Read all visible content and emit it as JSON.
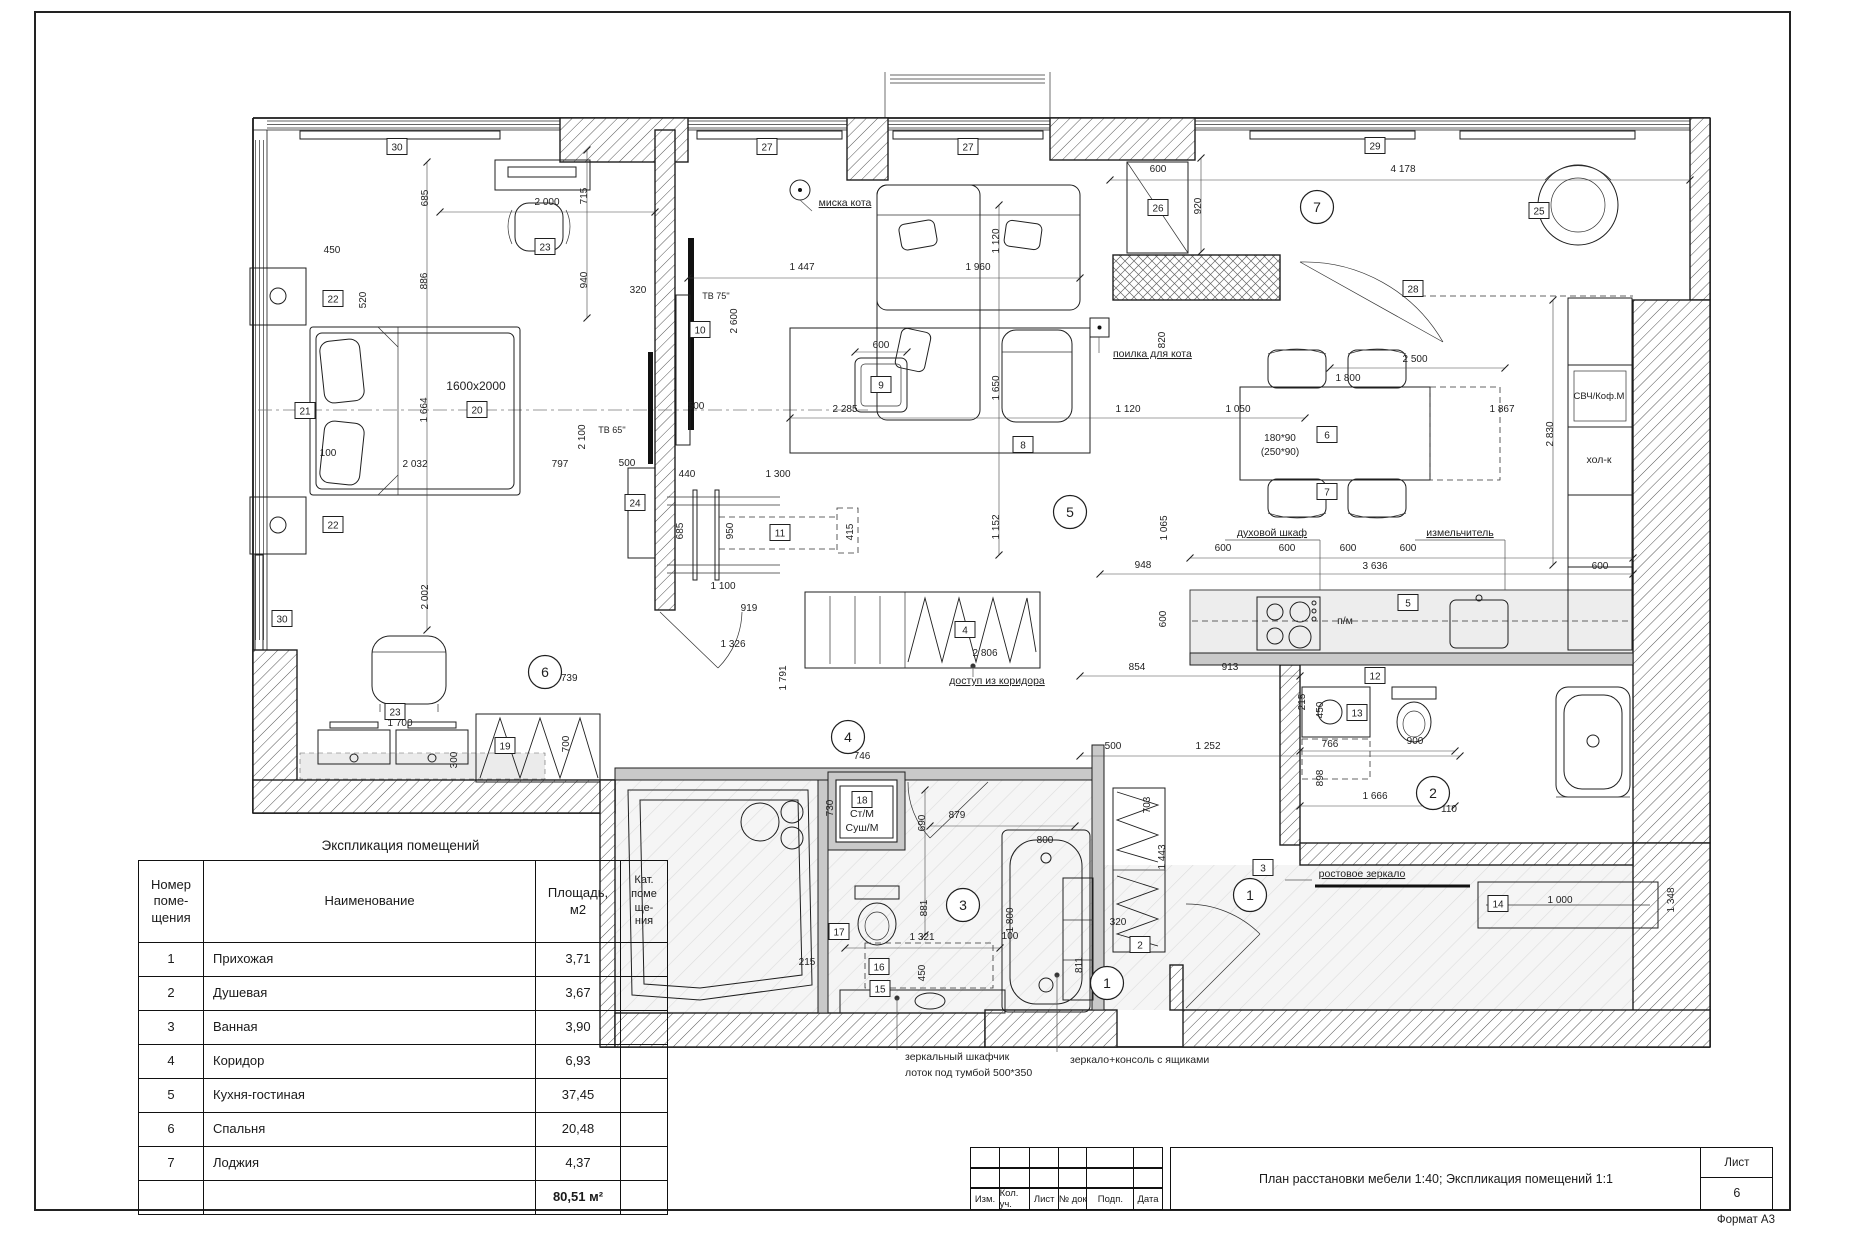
{
  "sheet": {
    "format": "Формат А3",
    "title": "План расстановки мебели 1:40; Экспликация помещений 1:1",
    "sheet_label": "Лист",
    "sheet_number": "6",
    "stamp_cols": [
      "Изм.",
      "Кол. уч.",
      "Лист",
      "№ док",
      "Подп.",
      "Дата"
    ]
  },
  "explication": {
    "title": "Экспликация помещений",
    "headers": [
      "Номер\nпоме-\nщения",
      "Наименование",
      "Площадь,\nм2",
      "Кат.\nпоме\nще-\nния"
    ],
    "rows": [
      {
        "num": "1",
        "name": "Прихожая",
        "area": "3,71",
        "cat": ""
      },
      {
        "num": "2",
        "name": "Душевая",
        "area": "3,67",
        "cat": ""
      },
      {
        "num": "3",
        "name": "Ванная",
        "area": "3,90",
        "cat": ""
      },
      {
        "num": "4",
        "name": "Коридор",
        "area": "6,93",
        "cat": ""
      },
      {
        "num": "5",
        "name": "Кухня-гостиная",
        "area": "37,45",
        "cat": ""
      },
      {
        "num": "6",
        "name": "Спальня",
        "area": "20,48",
        "cat": ""
      },
      {
        "num": "7",
        "name": "Лоджия",
        "area": "4,37",
        "cat": ""
      }
    ],
    "total_area": "80,51 м²"
  },
  "plan": {
    "room_markers": [
      {
        "n": "7",
        "x": 1317,
        "y": 207
      },
      {
        "n": "5",
        "x": 1070,
        "y": 512
      },
      {
        "n": "6",
        "x": 545,
        "y": 672
      },
      {
        "n": "4",
        "x": 848,
        "y": 737
      },
      {
        "n": "3",
        "x": 963,
        "y": 905
      },
      {
        "n": "2",
        "x": 1433,
        "y": 793
      },
      {
        "n": "1",
        "x": 1250,
        "y": 895
      },
      {
        "n": "1",
        "x": 1107,
        "y": 983
      }
    ],
    "item_markers": [
      {
        "n": "30",
        "x": 397,
        "y": 147
      },
      {
        "n": "27",
        "x": 767,
        "y": 147
      },
      {
        "n": "27",
        "x": 968,
        "y": 147
      },
      {
        "n": "29",
        "x": 1375,
        "y": 146
      },
      {
        "n": "26",
        "x": 1158,
        "y": 208
      },
      {
        "n": "25",
        "x": 1539,
        "y": 211
      },
      {
        "n": "28",
        "x": 1413,
        "y": 289
      },
      {
        "n": "23",
        "x": 545,
        "y": 247
      },
      {
        "n": "22",
        "x": 333,
        "y": 299
      },
      {
        "n": "21",
        "x": 305,
        "y": 411
      },
      {
        "n": "20",
        "x": 477,
        "y": 410
      },
      {
        "n": "22",
        "x": 333,
        "y": 525
      },
      {
        "n": "24",
        "x": 635,
        "y": 503
      },
      {
        "n": "10",
        "x": 700,
        "y": 330
      },
      {
        "n": "9",
        "x": 881,
        "y": 385
      },
      {
        "n": "8",
        "x": 1023,
        "y": 445
      },
      {
        "n": "11",
        "x": 780,
        "y": 533
      },
      {
        "n": "6",
        "x": 1327,
        "y": 435
      },
      {
        "n": "7",
        "x": 1327,
        "y": 492
      },
      {
        "n": "5",
        "x": 1408,
        "y": 603
      },
      {
        "n": "12",
        "x": 1375,
        "y": 676
      },
      {
        "n": "13",
        "x": 1357,
        "y": 713
      },
      {
        "n": "30",
        "x": 282,
        "y": 619
      },
      {
        "n": "23",
        "x": 395,
        "y": 712
      },
      {
        "n": "19",
        "x": 505,
        "y": 746
      },
      {
        "n": "4",
        "x": 965,
        "y": 630
      },
      {
        "n": "18",
        "x": 862,
        "y": 800
      },
      {
        "n": "17",
        "x": 839,
        "y": 932
      },
      {
        "n": "16",
        "x": 879,
        "y": 967
      },
      {
        "n": "15",
        "x": 880,
        "y": 989
      },
      {
        "n": "14",
        "x": 1498,
        "y": 904
      },
      {
        "n": "3",
        "x": 1263,
        "y": 868
      },
      {
        "n": "2",
        "x": 1140,
        "y": 945
      }
    ],
    "dim_labels": [
      {
        "t": "2 000",
        "x": 547,
        "y": 205
      },
      {
        "t": "450",
        "x": 332,
        "y": 253
      },
      {
        "t": "320",
        "x": 638,
        "y": 293
      },
      {
        "t": "1 447",
        "x": 802,
        "y": 270
      },
      {
        "t": "1 960",
        "x": 978,
        "y": 270
      },
      {
        "t": "600",
        "x": 1158,
        "y": 172
      },
      {
        "t": "4 178",
        "x": 1403,
        "y": 172
      },
      {
        "t": "1600x2000",
        "x": 476,
        "y": 390,
        "s": 12
      },
      {
        "t": "100",
        "x": 328,
        "y": 456
      },
      {
        "t": "2 032",
        "x": 415,
        "y": 467
      },
      {
        "t": "797",
        "x": 560,
        "y": 467
      },
      {
        "t": "500",
        "x": 696,
        "y": 409
      },
      {
        "t": "500",
        "x": 627,
        "y": 466
      },
      {
        "t": "440",
        "x": 687,
        "y": 477
      },
      {
        "t": "1 300",
        "x": 778,
        "y": 477
      },
      {
        "t": "1 100",
        "x": 723,
        "y": 589
      },
      {
        "t": "919",
        "x": 749,
        "y": 611
      },
      {
        "t": "1 326",
        "x": 733,
        "y": 647
      },
      {
        "t": "1 739",
        "x": 565,
        "y": 681
      },
      {
        "t": "1 700",
        "x": 400,
        "y": 726
      },
      {
        "t": "2 285",
        "x": 845,
        "y": 412
      },
      {
        "t": "600",
        "x": 881,
        "y": 348
      },
      {
        "t": "1 120",
        "x": 1128,
        "y": 412
      },
      {
        "t": "1 050",
        "x": 1238,
        "y": 412
      },
      {
        "t": "1 800",
        "x": 1348,
        "y": 381
      },
      {
        "t": "2 500",
        "x": 1415,
        "y": 362
      },
      {
        "t": "1 867",
        "x": 1502,
        "y": 412
      },
      {
        "t": "948",
        "x": 1143,
        "y": 568
      },
      {
        "t": "600",
        "x": 1223,
        "y": 551
      },
      {
        "t": "600",
        "x": 1287,
        "y": 551
      },
      {
        "t": "600",
        "x": 1348,
        "y": 551
      },
      {
        "t": "600",
        "x": 1408,
        "y": 551
      },
      {
        "t": "3 636",
        "x": 1375,
        "y": 569
      },
      {
        "t": "600",
        "x": 1600,
        "y": 569
      },
      {
        "t": "854",
        "x": 1137,
        "y": 670
      },
      {
        "t": "913",
        "x": 1230,
        "y": 670
      },
      {
        "t": "746",
        "x": 862,
        "y": 759
      },
      {
        "t": "879",
        "x": 957,
        "y": 818
      },
      {
        "t": "1 321",
        "x": 922,
        "y": 940
      },
      {
        "t": "215",
        "x": 807,
        "y": 965
      },
      {
        "t": "100",
        "x": 1010,
        "y": 939
      },
      {
        "t": "800",
        "x": 1045,
        "y": 843
      },
      {
        "t": "320",
        "x": 1118,
        "y": 925
      },
      {
        "t": "500",
        "x": 1113,
        "y": 749
      },
      {
        "t": "1 252",
        "x": 1208,
        "y": 749
      },
      {
        "t": "766",
        "x": 1330,
        "y": 747
      },
      {
        "t": "900",
        "x": 1415,
        "y": 744
      },
      {
        "t": "1 666",
        "x": 1375,
        "y": 799
      },
      {
        "t": "110",
        "x": 1449,
        "y": 812
      },
      {
        "t": "1 000",
        "x": 1560,
        "y": 903
      },
      {
        "t": "2 806",
        "x": 985,
        "y": 656
      },
      {
        "t": "180*90",
        "x": 1280,
        "y": 441
      },
      {
        "t": "(250*90)",
        "x": 1280,
        "y": 455
      },
      {
        "t": "685",
        "v": 1,
        "x": 428,
        "y": 198
      },
      {
        "t": "715",
        "v": 1,
        "x": 587,
        "y": 196
      },
      {
        "t": "886",
        "v": 1,
        "x": 427,
        "y": 281
      },
      {
        "t": "940",
        "v": 1,
        "x": 587,
        "y": 280
      },
      {
        "t": "520",
        "v": 1,
        "x": 366,
        "y": 300
      },
      {
        "t": "2 600",
        "v": 1,
        "x": 737,
        "y": 321
      },
      {
        "t": "2 100",
        "v": 1,
        "x": 585,
        "y": 437
      },
      {
        "t": "1 664",
        "v": 1,
        "x": 427,
        "y": 410
      },
      {
        "t": "2 002",
        "v": 1,
        "x": 428,
        "y": 597
      },
      {
        "t": "700",
        "v": 1,
        "x": 569,
        "y": 744
      },
      {
        "t": "300",
        "v": 1,
        "x": 457,
        "y": 760
      },
      {
        "t": "685",
        "v": 1,
        "x": 683,
        "y": 531
      },
      {
        "t": "950",
        "v": 1,
        "x": 733,
        "y": 531
      },
      {
        "t": "415",
        "v": 1,
        "x": 853,
        "y": 532
      },
      {
        "t": "1 791",
        "v": 1,
        "x": 786,
        "y": 678
      },
      {
        "t": "920",
        "v": 1,
        "x": 1201,
        "y": 206
      },
      {
        "t": "1 120",
        "v": 1,
        "x": 999,
        "y": 241
      },
      {
        "t": "820",
        "v": 1,
        "x": 1165,
        "y": 340
      },
      {
        "t": "1 650",
        "v": 1,
        "x": 999,
        "y": 388
      },
      {
        "t": "1 152",
        "v": 1,
        "x": 999,
        "y": 527
      },
      {
        "t": "1 065",
        "v": 1,
        "x": 1167,
        "y": 528
      },
      {
        "t": "600",
        "v": 1,
        "x": 1166,
        "y": 619
      },
      {
        "t": "2 830",
        "v": 1,
        "x": 1553,
        "y": 434
      },
      {
        "t": "730",
        "v": 1,
        "x": 833,
        "y": 808
      },
      {
        "t": "690",
        "v": 1,
        "x": 925,
        "y": 823
      },
      {
        "t": "881",
        "v": 1,
        "x": 927,
        "y": 908
      },
      {
        "t": "1 800",
        "v": 1,
        "x": 1013,
        "y": 920
      },
      {
        "t": "450",
        "v": 1,
        "x": 925,
        "y": 973
      },
      {
        "t": "215",
        "v": 1,
        "x": 1305,
        "y": 702
      },
      {
        "t": "450",
        "v": 1,
        "x": 1323,
        "y": 710
      },
      {
        "t": "898",
        "v": 1,
        "x": 1323,
        "y": 778
      },
      {
        "t": "703",
        "v": 1,
        "x": 1150,
        "y": 805
      },
      {
        "t": "1 443",
        "v": 1,
        "x": 1165,
        "y": 857
      },
      {
        "t": "811",
        "v": 1,
        "x": 1082,
        "y": 965
      },
      {
        "t": "1 348",
        "v": 1,
        "x": 1674,
        "y": 900
      }
    ],
    "annotations": [
      {
        "t": "миска кота",
        "x": 845,
        "y": 206,
        "u": 1
      },
      {
        "t": "поилка для кота",
        "x": 1113,
        "y": 357,
        "a": "s",
        "u": 1
      },
      {
        "t": "доступ из коридора",
        "x": 997,
        "y": 684,
        "u": 1
      },
      {
        "t": "духовой шкаф",
        "x": 1272,
        "y": 536,
        "u": 1
      },
      {
        "t": "измельчитель",
        "x": 1460,
        "y": 536,
        "u": 1
      },
      {
        "t": "СВЧ/Коф.М",
        "x": 1599,
        "y": 399,
        "s": 9.5
      },
      {
        "t": "хол-к",
        "x": 1599,
        "y": 463
      },
      {
        "t": "п/м",
        "x": 1345,
        "y": 624
      },
      {
        "t": "ТВ 75''",
        "x": 716,
        "y": 299,
        "s": 9
      },
      {
        "t": "ТВ 65''",
        "x": 612,
        "y": 433,
        "s": 9
      },
      {
        "t": "Ст/М",
        "x": 862,
        "y": 817
      },
      {
        "t": "Суш/М",
        "x": 862,
        "y": 831
      },
      {
        "t": "зеркальный шкафчик",
        "x": 905,
        "y": 1060,
        "a": "s"
      },
      {
        "t": "лоток под тумбой 500*350",
        "x": 905,
        "y": 1076,
        "a": "s"
      },
      {
        "t": "зеркало+консоль с ящиками",
        "x": 1070,
        "y": 1063,
        "a": "s"
      },
      {
        "t": "ростовое зеркало",
        "x": 1362,
        "y": 877,
        "u": 1
      }
    ]
  }
}
